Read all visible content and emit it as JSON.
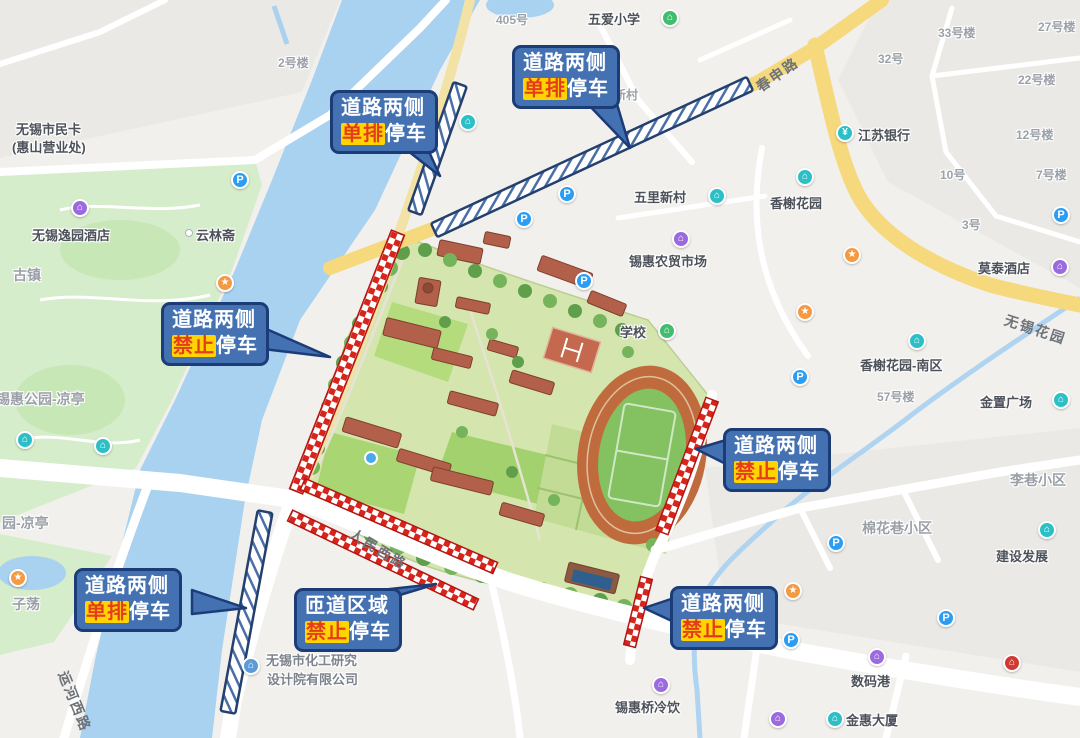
{
  "road_labels": {
    "chunshen_road": "春申路",
    "renmin_west_road": "人民西路",
    "yunhe_west_road": "运河西路",
    "wuxi_huayuan_road": "无锡花园"
  },
  "pois": {
    "no405": "405号",
    "wuai_primary_school": "五爱小学",
    "building2": "2号楼",
    "citizen_card_line1": "无锡市民卡",
    "citizen_card_line2": "(惠山营业处)",
    "yiyuan_hotel": "无锡逸园酒店",
    "yunlinzhai": "云林斋",
    "guzhen": "古镇",
    "xihui_park_pavilion": "锡惠公园-凉亭",
    "park_pavilion_partial": "园-凉亭",
    "zidang": "子荡",
    "xincun_partial": "新村",
    "wuli_xincun": "五里新村",
    "jiangsu_bank": "江苏银行",
    "xiangxie_garden": "香榭花园",
    "building33": "33号楼",
    "building32": "32号",
    "building27": "27号楼",
    "building22": "22号楼",
    "building12": "12号楼",
    "building10": "10号",
    "building7": "7号楼",
    "building3": "3号",
    "building57": "57号楼",
    "xihui_market": "锡惠农贸市场",
    "school": "学校",
    "motai_hotel": "莫泰酒店",
    "xiangxie_south": "香榭花园-南区",
    "jinzhi_plaza": "金置广场",
    "lixiang_community": "李巷小区",
    "mianhua_community": "棉花巷小区",
    "jianshe_fazhan": "建设发展",
    "shumagang": "数码港",
    "jinhui_building": "金惠大厦",
    "xihuiqiao_drinks": "锡惠桥冷饮",
    "chemical_line1": "无锡市化工研究",
    "chemical_line2": "设计院有限公司"
  },
  "callouts": {
    "upper_left": {
      "line1": "道路两侧",
      "highlight": "单排",
      "suffix": "停车"
    },
    "top_center": {
      "line1": "道路两侧",
      "highlight": "单排",
      "suffix": "停车"
    },
    "left_middle": {
      "line1": "道路两侧",
      "highlight": "禁止",
      "suffix": "停车"
    },
    "right_middle": {
      "line1": "道路两侧",
      "highlight": "禁止",
      "suffix": "停车"
    },
    "bottom_left": {
      "line1": "道路两侧",
      "highlight": "单排",
      "suffix": "停车"
    },
    "bottom_center": {
      "line1": "匝道区域",
      "highlight": "禁止",
      "suffix": "停车"
    },
    "bottom_right": {
      "line1": "道路两侧",
      "highlight": "禁止",
      "suffix": "停车"
    }
  },
  "colors": {
    "callout_fill": "#4371b2",
    "callout_border": "#1c3c77",
    "highlight_bg": "#ffd400",
    "highlight_text": "#e63c1e",
    "no_parking_bar_red": "#d6251d",
    "single_row_bar_stripe_blue": "#4a6ea8",
    "water": "#a9d1f0",
    "park_green": "#d5edcb",
    "main_road_yellow": "#f6d97c"
  }
}
